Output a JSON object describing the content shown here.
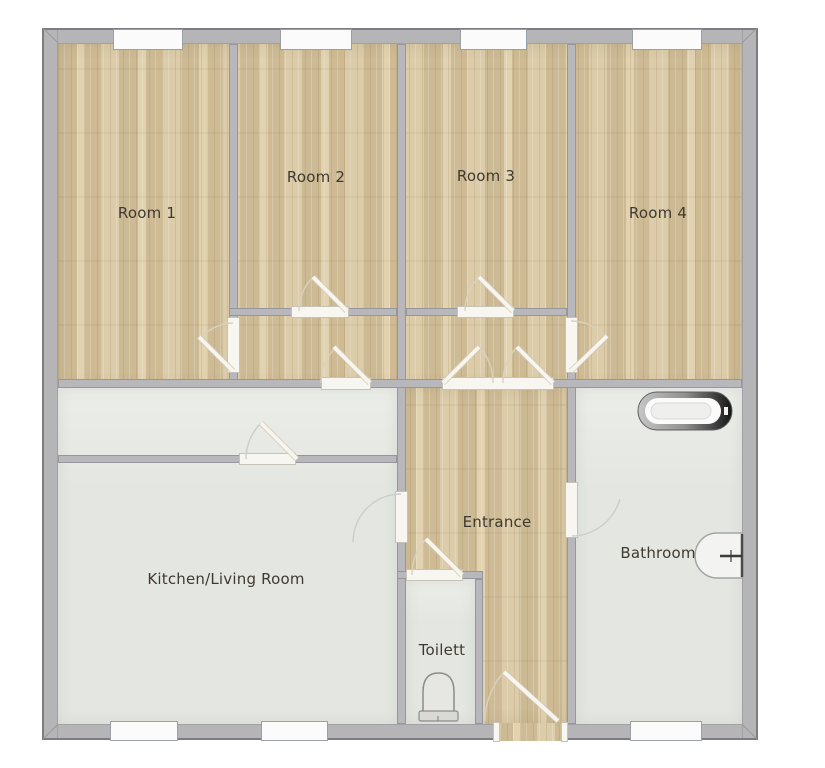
{
  "rooms": [
    {
      "id": "room-1",
      "label": "Room 1",
      "floor": "wood"
    },
    {
      "id": "room-2",
      "label": "Room 2",
      "floor": "wood"
    },
    {
      "id": "room-3",
      "label": "Room 3",
      "floor": "wood"
    },
    {
      "id": "room-4",
      "label": "Room 4",
      "floor": "wood"
    },
    {
      "id": "entrance",
      "label": "Entrance",
      "floor": "wood"
    },
    {
      "id": "kitchen-living-room",
      "label": "Kitchen/Living Room",
      "floor": "tile"
    },
    {
      "id": "toilet",
      "label": "Toilett",
      "floor": "tile"
    },
    {
      "id": "bathroom",
      "label": "Bathroom",
      "floor": "tile"
    }
  ],
  "fixtures": [
    {
      "id": "bathtub",
      "name": "bathtub",
      "located_in": "Bathroom"
    },
    {
      "id": "sink",
      "name": "sink",
      "located_in": "Bathroom"
    },
    {
      "id": "toilet-bowl",
      "name": "toilet",
      "located_in": "Toilett"
    }
  ],
  "symbol_counts": {
    "windows": 7,
    "door_openings": 11
  },
  "colors": {
    "wood_floor": "#d6c5a0",
    "tile_floor": "#e4e7e1",
    "wall": "#b8b8bc",
    "outer_wall_outline": "#7d7d81",
    "door_leaf": "#f8f5ee",
    "window": "#fbfbfb",
    "bathtub_rim_dark": "#141414",
    "label_text": "#3f3a31"
  }
}
